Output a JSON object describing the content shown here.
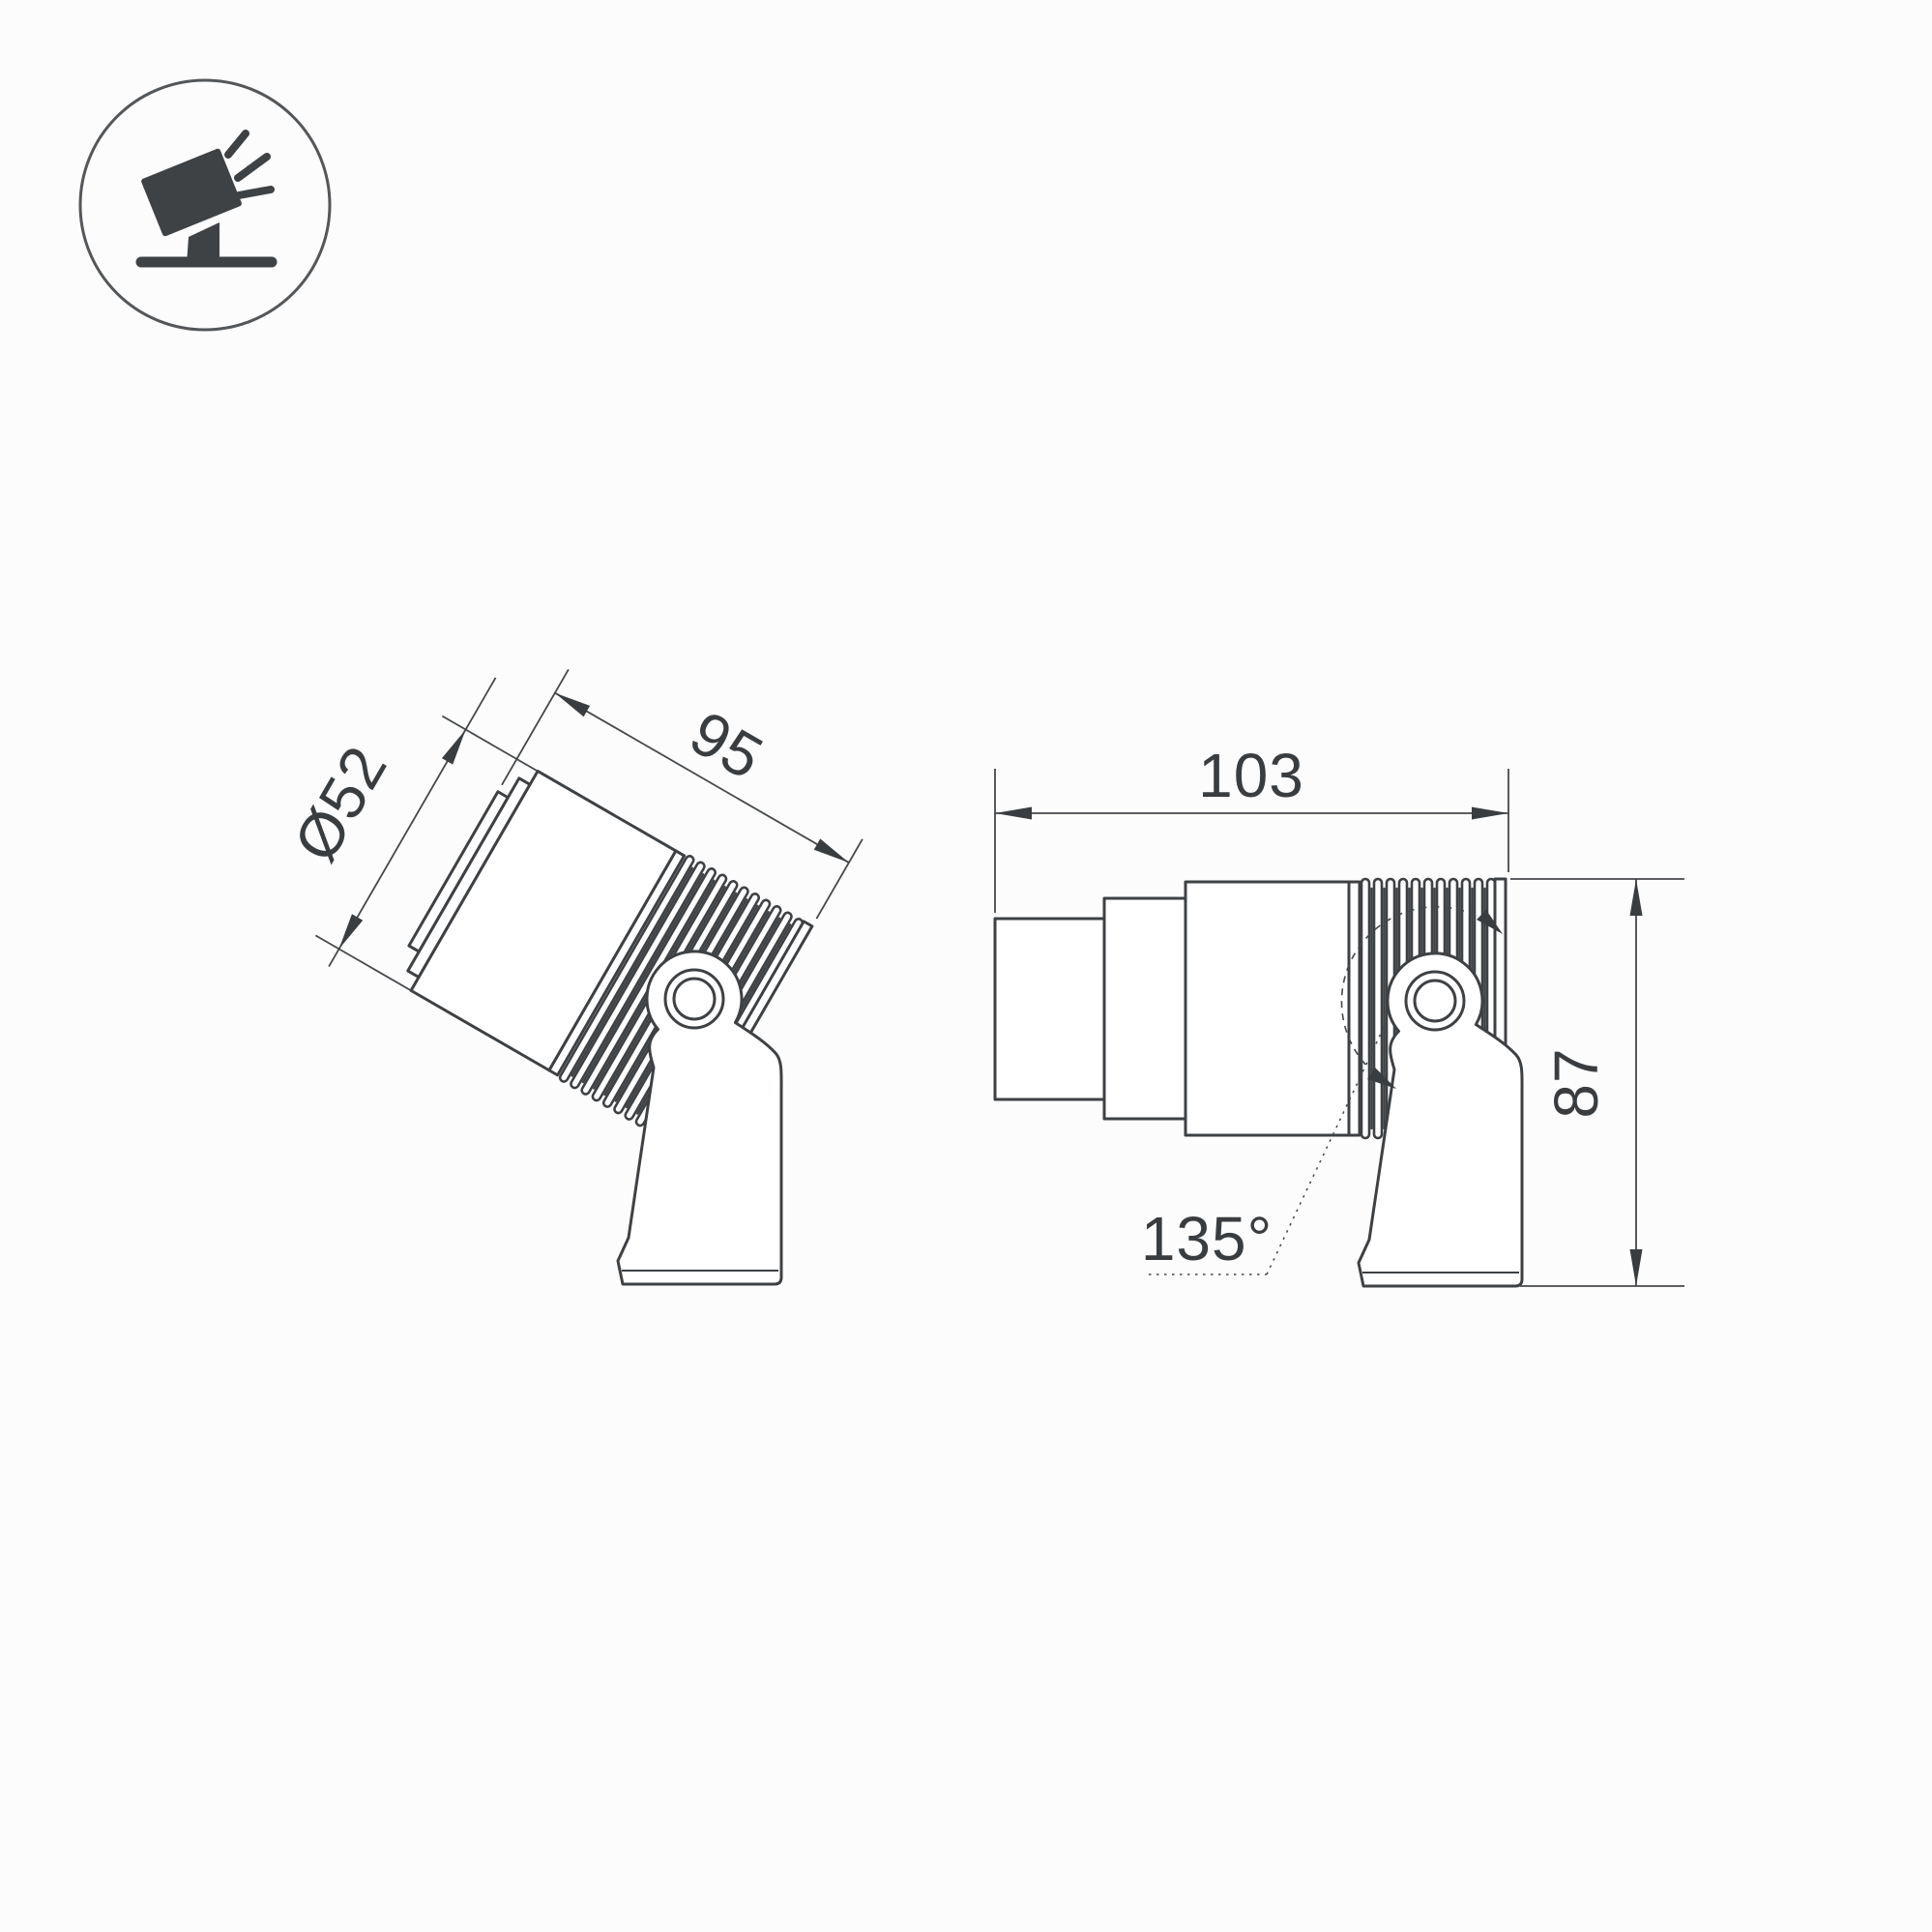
{
  "page": {
    "kind": "technical-dimension-drawing",
    "background": "#fcfcfc"
  },
  "colors": {
    "line": "#3e4144",
    "dimension_line": "#45484b",
    "text": "#3a3d40",
    "icon": "#3f4245",
    "background": "#fcfcfc"
  },
  "icon": {
    "name": "tilted-spotlight-icon"
  },
  "drawings": {
    "tilted_view": {
      "diameter_label": "Ø52",
      "length_label": "95"
    },
    "side_view": {
      "length_label": "103",
      "height_label": "87",
      "tilt_range_label": "135°"
    }
  }
}
